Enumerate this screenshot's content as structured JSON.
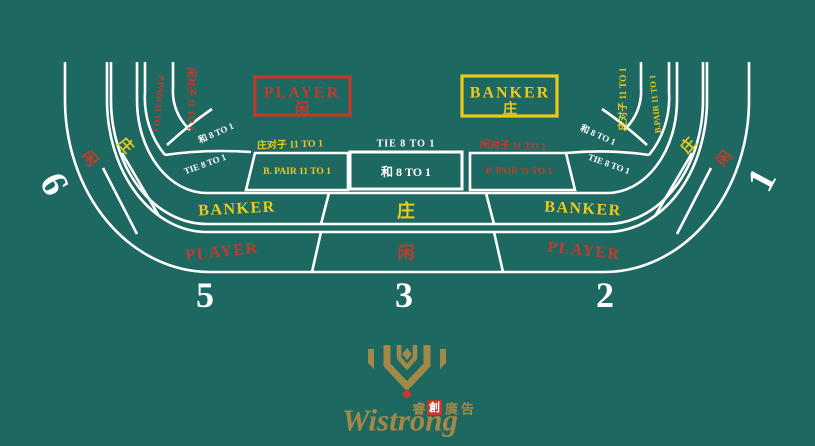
{
  "colors": {
    "felt": "#1e6862",
    "line": "#ffffff",
    "red": "#c33a2b",
    "yellow": "#edc91c",
    "gold": "#a38947"
  },
  "top": {
    "player_box": {
      "en": "PLAYER",
      "cn": "闲"
    },
    "banker_box": {
      "en": "BANKER",
      "cn": "庄"
    }
  },
  "center": {
    "seat": "3",
    "tie_label": "TIE   8 TO 1",
    "tie_box": "和    8 TO 1",
    "banker_cn": "庄",
    "player_cn": "闲"
  },
  "left": {
    "seat": "5",
    "banker": "BANKER",
    "player": "PLAYER",
    "pair_box": "B. PAIR  11 TO 1",
    "pair_label": "庄对子 11 TO 1",
    "tie_rot": "TIE  8 TO 1",
    "tie_cn_rot": "和  8 TO 1"
  },
  "right": {
    "seat": "2",
    "banker": "BANKER",
    "player": "PLAYER",
    "pair_box": "P. PAIR  11 TO 1",
    "pair_label": "闲对子 11 TO 1",
    "tie_rot": "TIE  8 TO 1",
    "tie_cn_rot": "和  8 TO 1"
  },
  "corner_left": {
    "seat": "6",
    "player_cn": "闲",
    "banker_cn": "庄",
    "pair_rot": "P.PAIR 11 TO 1",
    "pair_cn_rot": "闲对子 11 TO 1"
  },
  "corner_right": {
    "seat": "1",
    "player_cn": "闲",
    "banker_cn": "庄",
    "pair_rot": "B.PAIR 11 TO 1",
    "pair_cn_rot": "庄对子 11 TO 1"
  },
  "logo": {
    "brand": "Wistrong",
    "cn_left": "睿",
    "cn_stamp": "創",
    "cn_right": "廣告"
  }
}
